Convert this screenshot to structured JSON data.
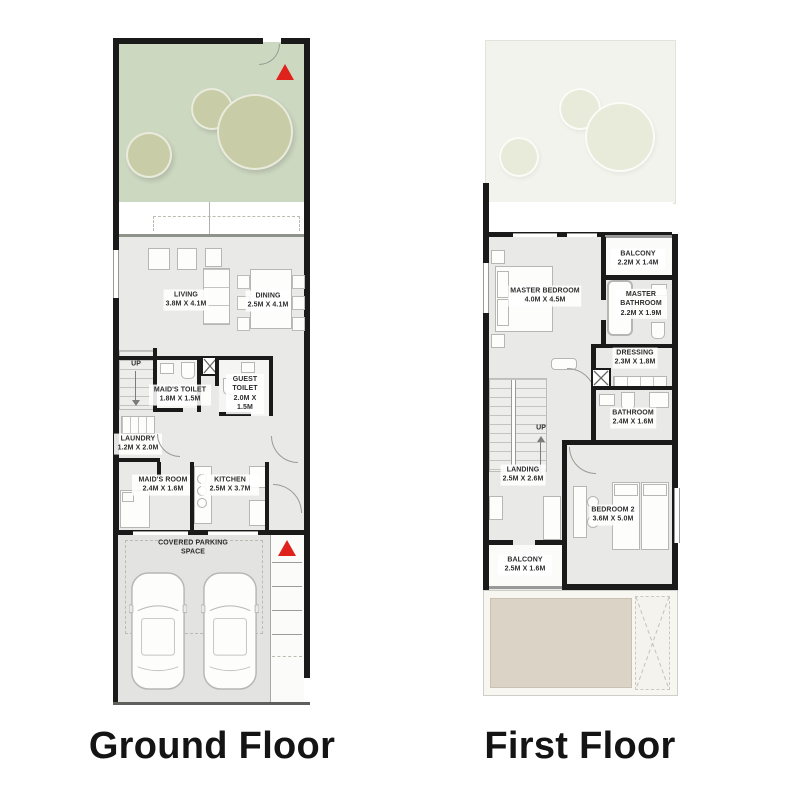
{
  "ground_floor": {
    "title": "Ground Floor",
    "rooms": {
      "living": {
        "name": "LIVING",
        "dims": "3.8M X 4.1M"
      },
      "dining": {
        "name": "DINING",
        "dims": "2.5M X 4.1M"
      },
      "maids_toilet": {
        "name": "MAID'S TOILET",
        "dims": "1.8M X 1.5M"
      },
      "guest_toilet": {
        "name": "GUEST TOILET",
        "dims": "2.0M X 1.5M"
      },
      "laundry": {
        "name": "LAUNDRY",
        "dims": "1.2M X 2.0M"
      },
      "maids_room": {
        "name": "MAID'S ROOM",
        "dims": "2.4M X 1.6M"
      },
      "kitchen": {
        "name": "KITCHEN",
        "dims": "2.5M X 3.7M"
      },
      "parking": {
        "name": "COVERED PARKING SPACE"
      },
      "up": "UP"
    }
  },
  "first_floor": {
    "title": "First Floor",
    "rooms": {
      "balcony_master": {
        "name": "BALCONY",
        "dims": "2.2M X 1.4M"
      },
      "master_bedroom": {
        "name": "MASTER BEDROOM",
        "dims": "4.0M X 4.5M"
      },
      "master_bathroom": {
        "name": "MASTER BATHROOM",
        "dims": "2.2M X 1.9M"
      },
      "dressing": {
        "name": "DRESSING",
        "dims": "2.3M X 1.8M"
      },
      "bathroom": {
        "name": "BATHROOM",
        "dims": "2.4M X 1.6M"
      },
      "landing": {
        "name": "LANDING",
        "dims": "2.5M X 2.6M"
      },
      "bedroom2": {
        "name": "BEDROOM 2",
        "dims": "3.6M X 5.0M"
      },
      "balcony2": {
        "name": "BALCONY",
        "dims": "2.5M X 1.6M"
      },
      "up": "UP"
    }
  },
  "colors": {
    "wall": "#1a1a1a",
    "garden_green": "#cdd8c1",
    "tree_olive": "#c9cda7",
    "interior_gray": "#e9e9e7",
    "sand_roof": "#dbd4c6",
    "entry_arrow_red": "#e0221c"
  }
}
